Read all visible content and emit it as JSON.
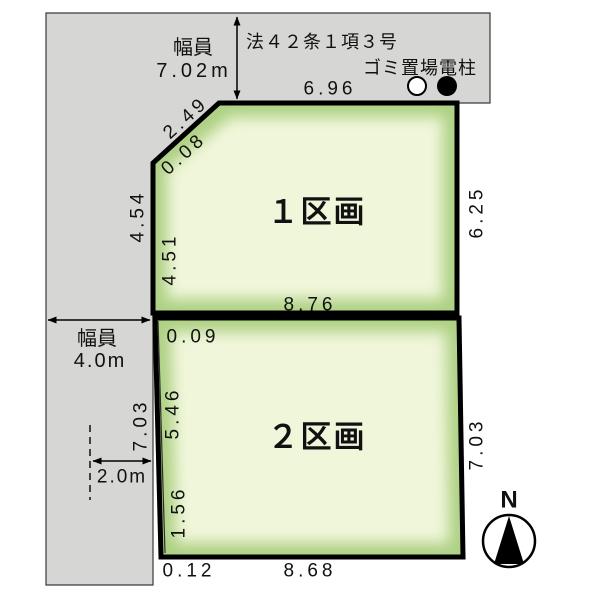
{
  "colors": {
    "road_fill": "#d6d6d4",
    "plot_edge_green": "#aed184",
    "plot_center_green": "#f0f6da",
    "line_black": "#000000"
  },
  "top_road": {
    "width_label": "幅員",
    "width_value": "7.02m",
    "law_text": "法４２条１項３号",
    "garbage_pole_label": "ゴミ置場電柱",
    "frontage": "6.96"
  },
  "left_road": {
    "width_label": "幅員",
    "width_value": "4.0m",
    "setback": "2.0m"
  },
  "plot1": {
    "name": "１区画",
    "diagonal": "2.49",
    "diagonal_offset": "0.08",
    "left_outer": "4.54",
    "left_inner": "4.51",
    "right": "6.25",
    "bottom": "8.76"
  },
  "plot2": {
    "name": "２区画",
    "top_offset": "0.09",
    "left_upper": "5.46",
    "left_road": "7.03",
    "left_lower": "1.56",
    "right": "7.03",
    "bottom": "8.68",
    "bottom_offset": "0.12"
  },
  "compass": {
    "north": "N"
  }
}
